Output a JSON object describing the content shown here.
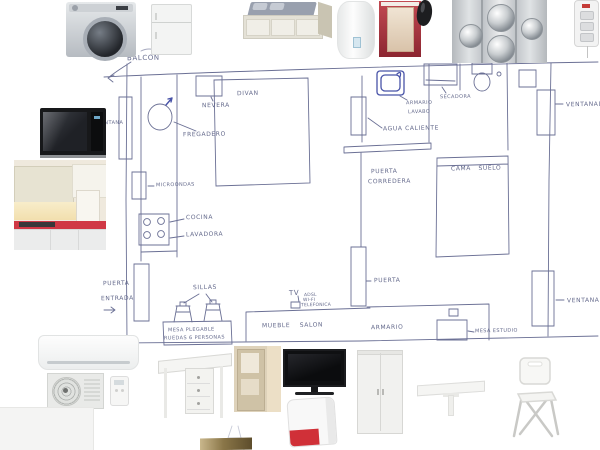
{
  "page": {
    "type": "apartment floor plan sketch with product moodboard"
  },
  "colors": {
    "pen": "#6b7095",
    "pen_text": "#575d82",
    "pen_blue": "#4853a8",
    "counter_red": "#cc3340",
    "vanity_red": "#a23440",
    "router_red": "#d03038"
  },
  "plan": {
    "labels": {
      "balcon": "BALCON",
      "nevera": "NEVERA",
      "fregadero": "FREGADERO",
      "ventana_left": "VENTANA",
      "microondas": "MICROONDAS",
      "cocina": "COCINA",
      "lavadora": "LAVADORA",
      "puerta_entrada_1": "PUERTA",
      "puerta_entrada_2": "ENTRADA",
      "divan": "DIVAN",
      "sillas": "SILLAS",
      "mesa_plegable_1": "MESA PLEGABLE",
      "mesa_plegable_2": "RUEDAS 6 PERSONAS",
      "mueble_salon": "MUEBLE SALON",
      "tv": "TV",
      "tv_adsl": "ADSL",
      "tv_wifi": "WI-FI",
      "tv_telefonica": "TELEFONICA",
      "puerta_corredera_1": "PUERTA",
      "puerta_corredera_2": "CORREDERA",
      "agua_caliente": "AGUA CALIENTE",
      "armario_lavabo_1": "ARMARIO",
      "armario_lavabo_2": "LAVABO",
      "secadora": "SECADORA",
      "cama_suelo": "CAMA SUELO",
      "ventanal_top": "VENTANAL",
      "puerta_dormitorio": "PUERTA",
      "armario": "ARMARIO",
      "mesa_estudio": "MESA ESTUDIO",
      "ventanal_bottom": "VENTANAL"
    }
  },
  "products": {
    "top_row": [
      "washing-machine",
      "refrigerator",
      "daybed",
      "water-heater",
      "red-bathroom-vanity",
      "shower-mixer",
      "shower-panel",
      "power-strip"
    ],
    "left_column": [
      "microwave",
      "kitchen-photo"
    ],
    "bottom_left": [
      "ac-indoor-unit",
      "ac-outdoor-unit",
      "ac-remote"
    ],
    "bottom_row": [
      "gateleg-table",
      "closet-photo",
      "flatscreen-tv",
      "wifi-router",
      "wardrobe",
      "wall-folding-table",
      "folding-chair"
    ]
  }
}
